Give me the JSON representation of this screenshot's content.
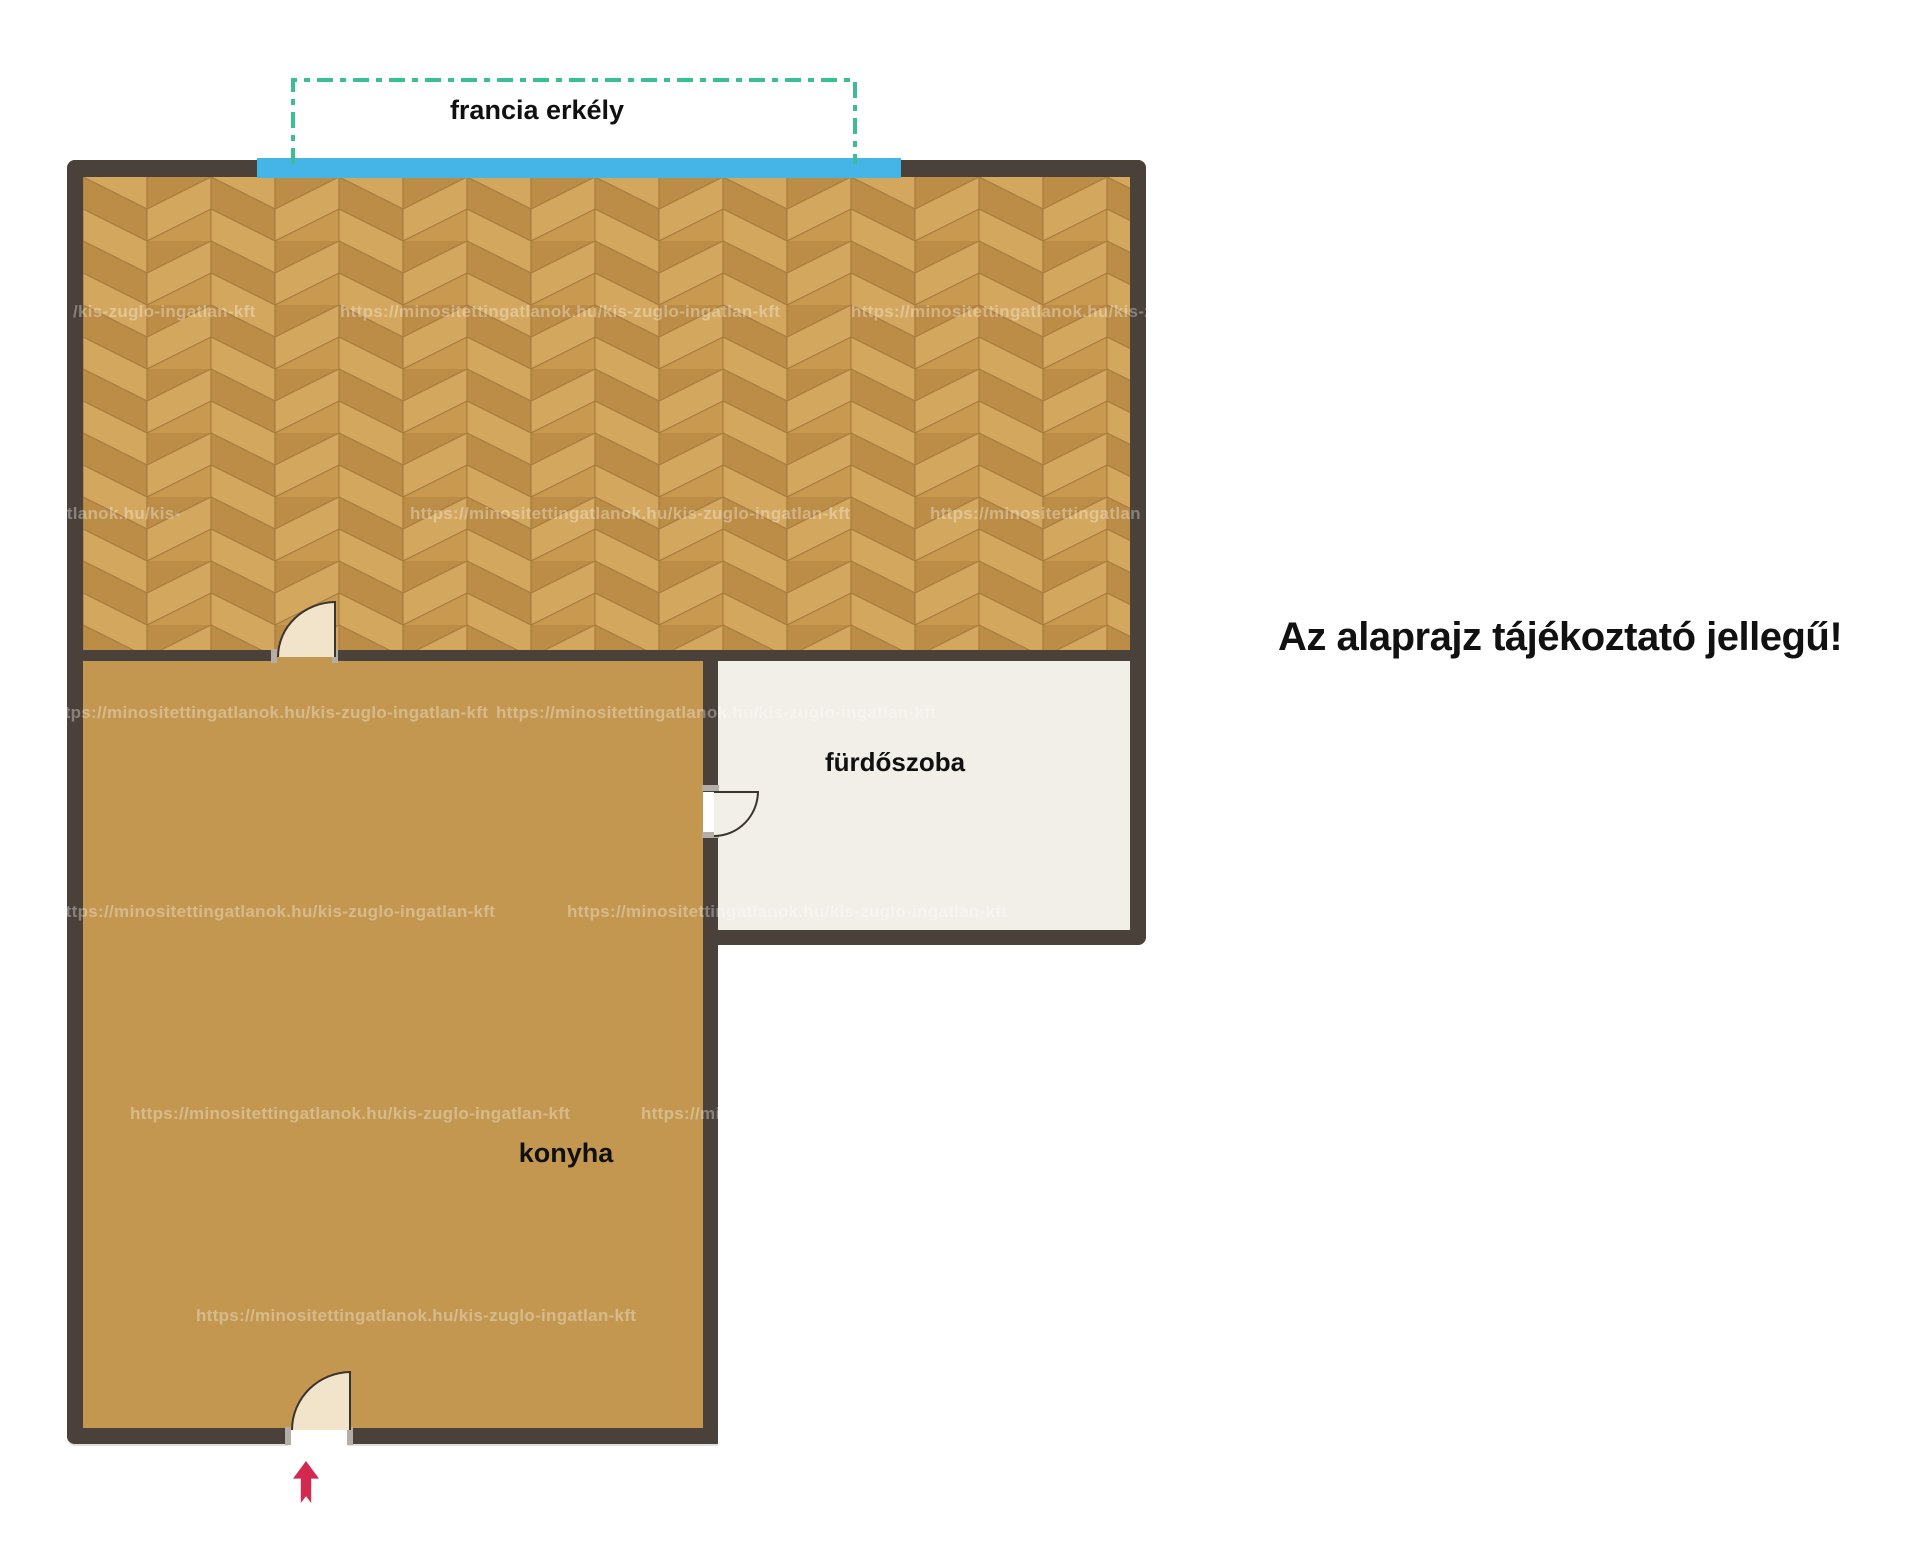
{
  "page": {
    "background": "#ffffff"
  },
  "disclaimer": {
    "text": "Az alaprajz tájékoztató jellegű!"
  },
  "labels": {
    "balcony": "francia erkély",
    "bathroom": "fürdőszoba",
    "kitchen": "konyha"
  },
  "colors": {
    "page": "#ffffff",
    "wall": "#4a413a",
    "kitchen_floor": "#c39750",
    "bathroom_floor": "#f2efe9",
    "parquet_light": "#d4a75f",
    "parquet_mid": "#c8994f",
    "parquet_dark": "#bc8d46",
    "parquet_seam": "#a87c40",
    "window": "#45b5e8",
    "balcony_dash": "#3bbd96",
    "door_fill": "#f2e4cb",
    "door_outline": "#3b342e",
    "arrow": "#d2294f",
    "watermark_color": "rgba(255,255,255,0.34)"
  },
  "watermark": {
    "url_full": "https://minositettingatlanok.hu/kis-zuglo-ingatlan-kft",
    "rows": [
      {
        "y": 302,
        "items": [
          {
            "x": 73,
            "text": "/kis-zuglo-ingatlan-kft"
          },
          {
            "x": 340,
            "text": "https://minositettingatlanok.hu/kis-zuglo-ingatlan-kft"
          },
          {
            "x": 851,
            "text": "https://minositettingatlanok.hu/kis-z"
          }
        ]
      },
      {
        "y": 504,
        "items": [
          {
            "x": 57,
            "text": "atlanok.hu/kis-"
          },
          {
            "x": 410,
            "text": "https://minositettingatlanok.hu/kis-zuglo-ingatlan-kft"
          },
          {
            "x": 930,
            "text": "https://minositettingatlan"
          }
        ]
      },
      {
        "y": 703,
        "items": [
          {
            "x": 48,
            "text": "https://minositettingatlanok.hu/kis-zuglo-ingatlan-kft"
          },
          {
            "x": 496,
            "text": "https://minositettingatlanok.hu/kis-zuglo-ingatlan-kft"
          }
        ]
      },
      {
        "y": 902,
        "items": [
          {
            "x": 55,
            "text": "https://minositettingatlanok.hu/kis-zuglo-ingatlan-kft"
          },
          {
            "x": 567,
            "text": "https://minositettingatlanok.hu/kis-zuglo-ingatlan-kft"
          }
        ]
      },
      {
        "y": 1104,
        "items": [
          {
            "x": 130,
            "text": "https://minositettingatlanok.hu/kis-zuglo-ingatlan-kft"
          },
          {
            "x": 641,
            "text": "https://minositettingatlanok.hu/kis-zuglo-ingatlan-kft"
          }
        ]
      },
      {
        "y": 1306,
        "items": [
          {
            "x": 196,
            "text": "https://minositettingatlanok.hu/kis-zuglo-ingatlan-kft"
          }
        ]
      }
    ]
  }
}
